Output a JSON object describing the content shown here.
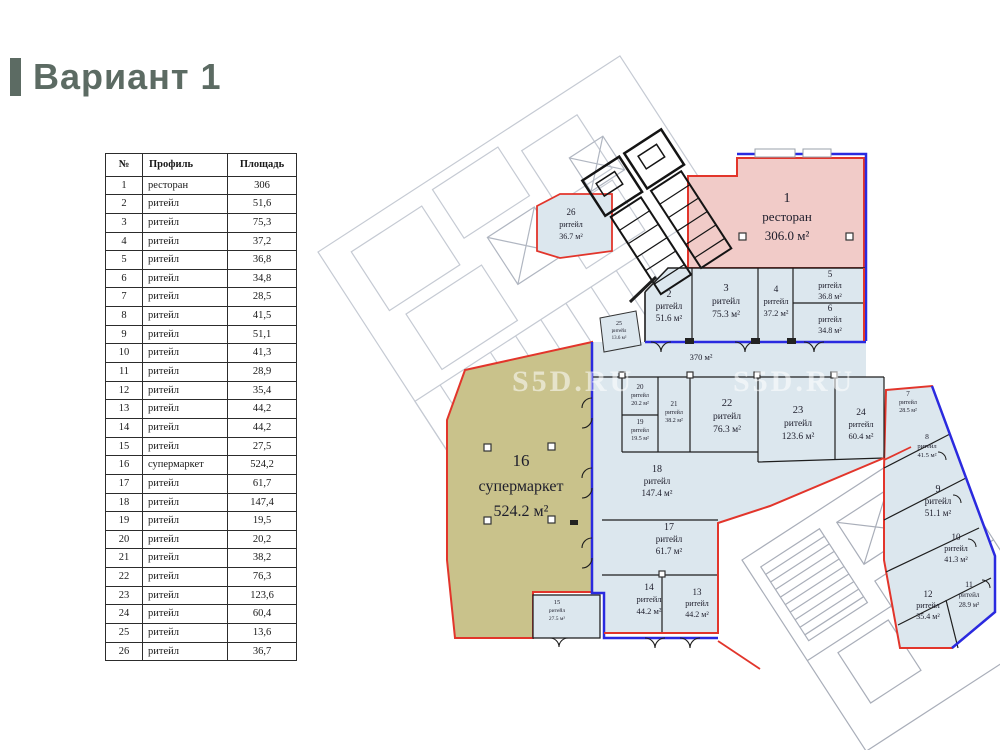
{
  "title": "Вариант 1",
  "table": {
    "headers": [
      "№",
      "Профиль",
      "Площадь"
    ],
    "rows": [
      [
        "1",
        "ресторан",
        "306"
      ],
      [
        "2",
        "ритейл",
        "51,6"
      ],
      [
        "3",
        "ритейл",
        "75,3"
      ],
      [
        "4",
        "ритейл",
        "37,2"
      ],
      [
        "5",
        "ритейл",
        "36,8"
      ],
      [
        "6",
        "ритейл",
        "34,8"
      ],
      [
        "7",
        "ритейл",
        "28,5"
      ],
      [
        "8",
        "ритейл",
        "41,5"
      ],
      [
        "9",
        "ритейл",
        "51,1"
      ],
      [
        "10",
        "ритейл",
        "41,3"
      ],
      [
        "11",
        "ритейл",
        "28,9"
      ],
      [
        "12",
        "ритейл",
        "35,4"
      ],
      [
        "13",
        "ритейл",
        "44,2"
      ],
      [
        "14",
        "ритейл",
        "44,2"
      ],
      [
        "15",
        "ритейл",
        "27,5"
      ],
      [
        "16",
        "супермаркет",
        "524,2"
      ],
      [
        "17",
        "ритейл",
        "61,7"
      ],
      [
        "18",
        "ритейл",
        "147,4"
      ],
      [
        "19",
        "ритейл",
        "19,5"
      ],
      [
        "20",
        "ритейл",
        "20,2"
      ],
      [
        "21",
        "ритейл",
        "38,2"
      ],
      [
        "22",
        "ритейл",
        "76,3"
      ],
      [
        "23",
        "ритейл",
        "123,6"
      ],
      [
        "24",
        "ритейл",
        "60,4"
      ],
      [
        "25",
        "ритейл",
        "13,6"
      ],
      [
        "26",
        "ритейл",
        "36,7"
      ]
    ]
  },
  "plan": {
    "corridor_label": "370 м²",
    "watermark": "S5D.RU",
    "rooms": [
      {
        "num": "1",
        "type": "ресторан",
        "area": "306.0 м²"
      },
      {
        "num": "2",
        "type": "ритейл",
        "area": "51.6 м²"
      },
      {
        "num": "3",
        "type": "ритейл",
        "area": "75.3 м²"
      },
      {
        "num": "4",
        "type": "ритейл",
        "area": "37.2 м²"
      },
      {
        "num": "5",
        "type": "ритейл",
        "area": "36.8 м²"
      },
      {
        "num": "6",
        "type": "ритейл",
        "area": "34.8 м²"
      },
      {
        "num": "7",
        "type": "ритейл",
        "area": "28.5 м²"
      },
      {
        "num": "8",
        "type": "ритейл",
        "area": "41.5 м²"
      },
      {
        "num": "9",
        "type": "ритейл",
        "area": "51.1 м²"
      },
      {
        "num": "10",
        "type": "ритейл",
        "area": "41.3 м²"
      },
      {
        "num": "11",
        "type": "ритейл",
        "area": "28.9 м²"
      },
      {
        "num": "12",
        "type": "ритейл",
        "area": "35.4 м²"
      },
      {
        "num": "13",
        "type": "ритейл",
        "area": "44.2 м²"
      },
      {
        "num": "14",
        "type": "ритейл",
        "area": "44.2 м²"
      },
      {
        "num": "15",
        "type": "ритейл",
        "area": "27.5 м²"
      },
      {
        "num": "16",
        "type": "супермаркет",
        "area": "524.2 м²"
      },
      {
        "num": "17",
        "type": "ритейл",
        "area": "61.7 м²"
      },
      {
        "num": "18",
        "type": "ритейл",
        "area": "147.4 м²"
      },
      {
        "num": "19",
        "type": "ритейл",
        "area": "19.5 м²"
      },
      {
        "num": "20",
        "type": "ритейл",
        "area": "20.2 м²"
      },
      {
        "num": "21",
        "type": "ритейл",
        "area": "38.2 м²"
      },
      {
        "num": "22",
        "type": "ритейл",
        "area": "76.3 м²"
      },
      {
        "num": "23",
        "type": "ритейл",
        "area": "123.6 м²"
      },
      {
        "num": "24",
        "type": "ритейл",
        "area": "60.4 м²"
      },
      {
        "num": "25",
        "type": "ритейл",
        "area": "13.6 м²"
      },
      {
        "num": "26",
        "type": "ритейл",
        "area": "36.7 м²"
      }
    ],
    "colors": {
      "title": "#5c6b63",
      "restaurant_fill": "#f1cbc8",
      "retail_fill": "#dce7ee",
      "supermarket_fill": "#c9c28b",
      "lease_line_red": "#e2352b",
      "boundary_line_blue": "#2a2ae0",
      "background_building_gray": "#c5cad3"
    }
  }
}
